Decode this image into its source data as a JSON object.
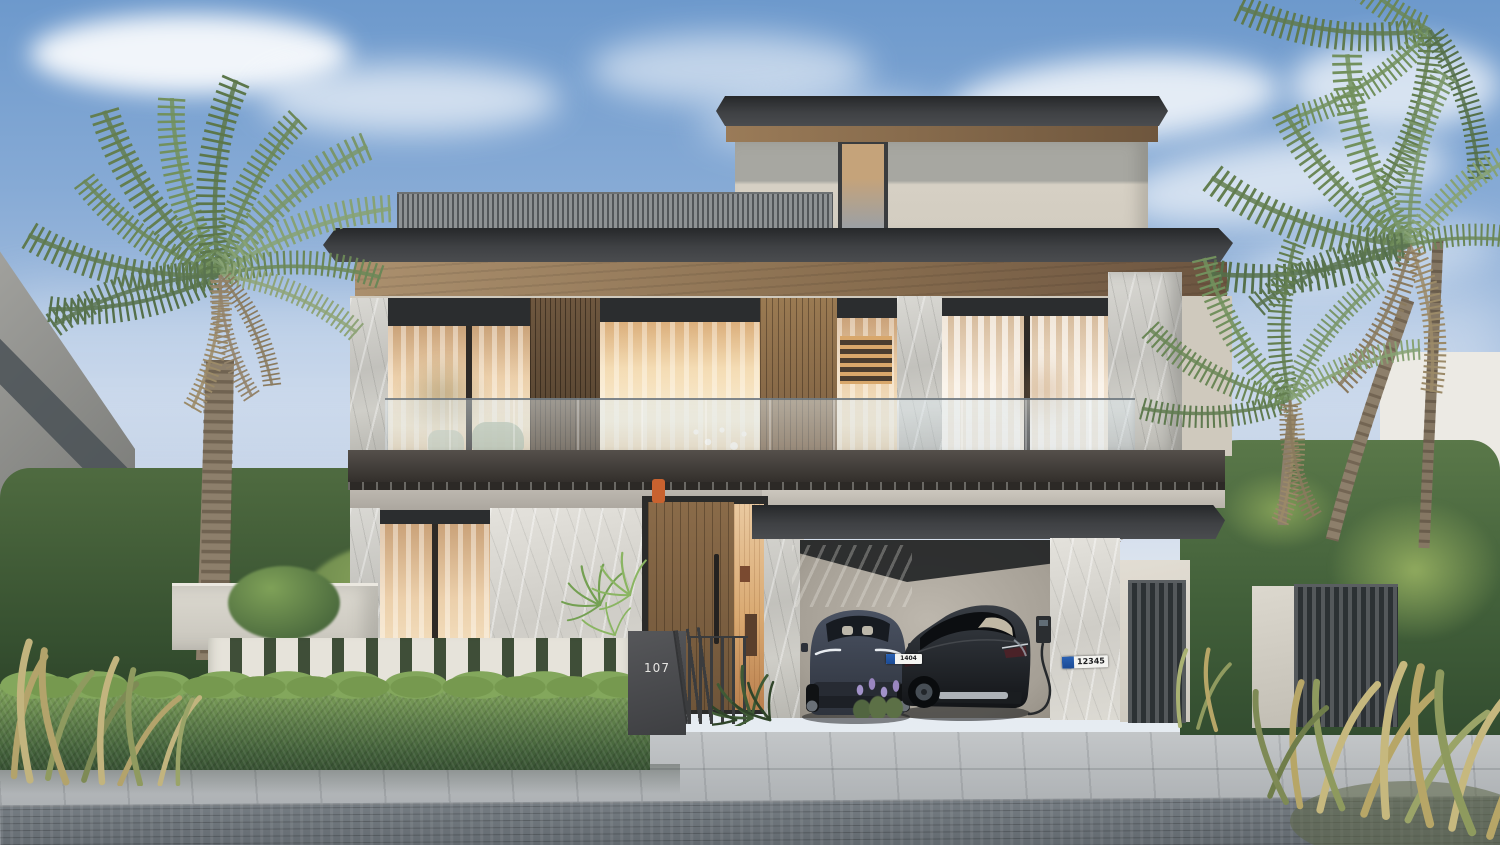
{
  "scene": {
    "type": "exterior-architectural-rendering",
    "subject": "modern three-storey villa with carport, palms and hedges",
    "time_of_day": "day",
    "house_number": "107"
  },
  "vehicles": {
    "car_left": {
      "body": "dark blue-grey crossover",
      "plate_number": "1404"
    },
    "car_right": {
      "body": "black sedan",
      "plate_number": "12345"
    }
  },
  "palette": {
    "sky_top": "#6d99cc",
    "sky_horizon": "#e9edf2",
    "cloud": "#ffffff",
    "roof_fascia": "#2e3032",
    "wood_soffit": "#8a6d4f",
    "stucco": "#d6d0c4",
    "marble": "#cbcac5",
    "wood_cladding": "#93744f",
    "glass_warm": "#e9c79d",
    "balcony_band": "#45403c",
    "hedge_green": "#5d7d49",
    "palm_green": "#6d8757",
    "palm_trunk": "#8d7f6b",
    "fence_white": "#e2dfd7",
    "gate_metal": "#4a4d4f",
    "pavement": "#b5b9bc",
    "cobblestone": "#70777d",
    "car_left_body": "#3a4150",
    "car_right_body": "#1d2024",
    "plate_badge_blue": "#1d4f9e",
    "ev_cable": "#2f3236",
    "door_accent_orange": "#c9622f"
  }
}
